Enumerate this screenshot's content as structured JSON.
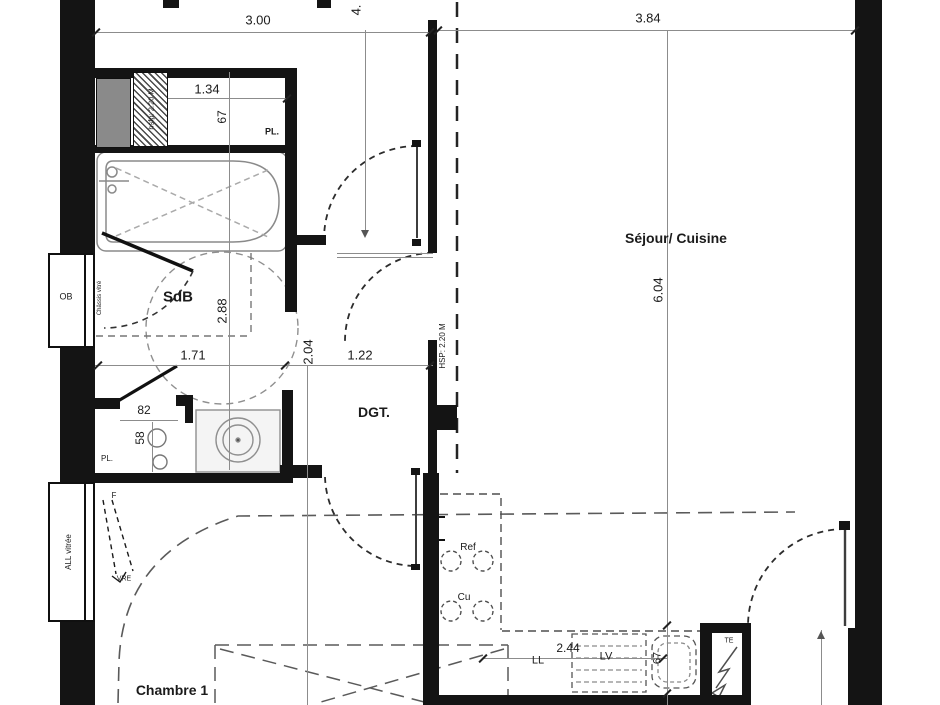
{
  "plan": {
    "title": "floor plan",
    "rooms": {
      "sdb": "SdB",
      "dgt": "DGT.",
      "sejour": "Séjour/ Cuisine",
      "chambre1": "Chambre 1"
    },
    "dimensions": {
      "top_left_width": "3.00",
      "top_right_width": "3.84",
      "entry_depth": "4.",
      "closet_width": "1.34",
      "closet_depth": "67",
      "sdb_height": "2.88",
      "sdb_width": "1.71",
      "dgt_width": "2.04",
      "entry_width": "1.22",
      "sejour_height": "6.04",
      "wc_width": "82",
      "wc_depth": "58",
      "kitchen_run": "2.44",
      "kitchen_depth": "67"
    },
    "labels": {
      "closet_top": "PL.",
      "closet_wc": "PL.",
      "window_ob": "OB",
      "chassis": "Châssis vitré",
      "hsfp_note": "hsfp: 2.20 M",
      "hsp_note": "HSP: 2.20 M",
      "window_sill": "ALL vitrée",
      "window_f": "F",
      "window_vre": "VRE",
      "fridge": "Ref",
      "cooker": "Cu",
      "washer": "LL",
      "dishwasher": "LV",
      "electrical": "TE"
    },
    "colors": {
      "wall": "#141414",
      "dimension_line": "#8c8c8c",
      "fixture_line": "#8a8a8a",
      "dash_line": "#3a3a3a"
    }
  }
}
